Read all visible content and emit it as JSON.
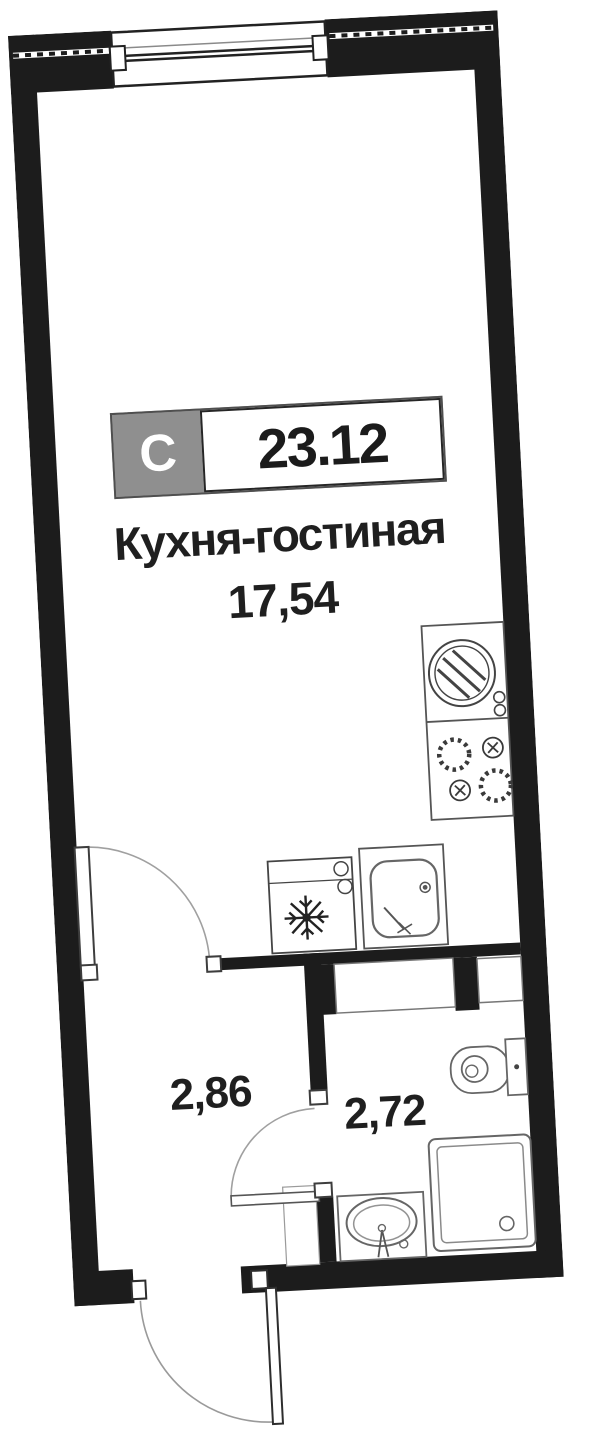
{
  "unit_badge": {
    "type_label": "С",
    "total_area": "23.12"
  },
  "rooms": [
    {
      "id": "kitchen-living",
      "label": "Кухня-гостиная",
      "area": "17,54"
    },
    {
      "id": "hallway",
      "label": "",
      "area": "2,86"
    },
    {
      "id": "bathroom",
      "label": "",
      "area": "2,72"
    }
  ],
  "fixtures": [
    "window",
    "entrance-door",
    "kitchen-door",
    "bathroom-door",
    "round-kitchen-sink",
    "cooktop-4-burners",
    "fridge",
    "kitchen-sink",
    "toilet",
    "shower-cabin",
    "bathroom-sink",
    "ventilation-niche"
  ],
  "colors": {
    "wall": "#1c1c1c",
    "fixture_stroke": "#666666",
    "arc_stroke": "#9a9a9a",
    "badge_gray": "#8f8f8f",
    "badge_border": "#4f4f4f",
    "text": "#1f1f1f",
    "background": "#ffffff"
  }
}
